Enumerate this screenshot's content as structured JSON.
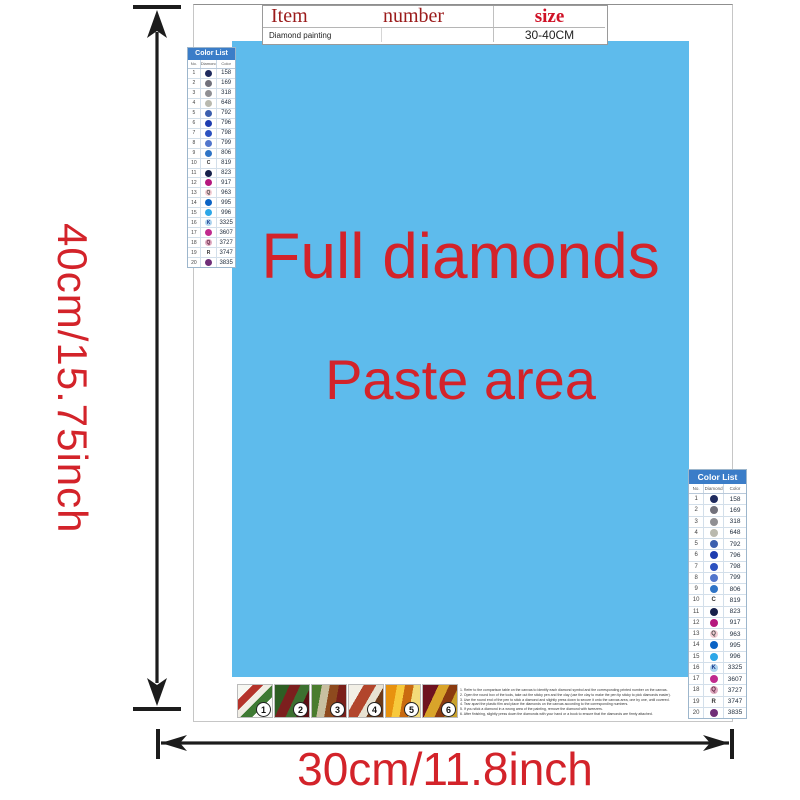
{
  "top_table": {
    "col_item": "Item",
    "col_number": "number",
    "col_size": "size",
    "row_item": "Diamond painting",
    "row_number": "",
    "row_size": "30-40CM"
  },
  "paste_area": {
    "line1": "Full diamonds",
    "line2": "Paste area",
    "bg_color": "#5ebbec",
    "text_color": "#d3232a"
  },
  "dimensions": {
    "height_label": "40cm/15.75inch",
    "width_label": "30cm/11.8inch",
    "arrow_color": "#1c1c1c",
    "label_color": "#d3232a"
  },
  "color_list": {
    "title": "Color List",
    "header_bg": "#3b7dc8",
    "col_no": "No.",
    "col_diamond": "Diamond",
    "col_color": "Color",
    "rows": [
      {
        "no": "1",
        "sym": "",
        "bg": "#1e2a5e",
        "fg": "#ffffff",
        "code": "158"
      },
      {
        "no": "2",
        "sym": "",
        "bg": "#71717b",
        "fg": "#ffffff",
        "code": "169"
      },
      {
        "no": "3",
        "sym": "",
        "bg": "#8f8f93",
        "fg": "#ffffff",
        "code": "318"
      },
      {
        "no": "4",
        "sym": "",
        "bg": "#b9b9ae",
        "fg": "#ffffff",
        "code": "648"
      },
      {
        "no": "5",
        "sym": "",
        "bg": "#3c5fae",
        "fg": "#ffffff",
        "code": "792"
      },
      {
        "no": "6",
        "sym": "",
        "bg": "#1e3db0",
        "fg": "#ffffff",
        "code": "796"
      },
      {
        "no": "7",
        "sym": "",
        "bg": "#2c52c0",
        "fg": "#ffffff",
        "code": "798"
      },
      {
        "no": "8",
        "sym": "",
        "bg": "#5276cc",
        "fg": "#ffffff",
        "code": "799"
      },
      {
        "no": "9",
        "sym": "",
        "bg": "#2f74c6",
        "fg": "#ffffff",
        "code": "806"
      },
      {
        "no": "10",
        "sym": "C",
        "bg": "none",
        "fg": "#333333",
        "code": "819"
      },
      {
        "no": "11",
        "sym": "",
        "bg": "#16204a",
        "fg": "#ffffff",
        "code": "823"
      },
      {
        "no": "12",
        "sym": "",
        "bg": "#b5187e",
        "fg": "#ffffff",
        "code": "917"
      },
      {
        "no": "13",
        "sym": "Q",
        "bg": "#f3cdd4",
        "fg": "#444444",
        "code": "963"
      },
      {
        "no": "14",
        "sym": "",
        "bg": "#0b63c5",
        "fg": "#ffffff",
        "code": "995"
      },
      {
        "no": "15",
        "sym": "",
        "bg": "#2da7e8",
        "fg": "#ffffff",
        "code": "996"
      },
      {
        "no": "16",
        "sym": "K",
        "bg": "#aed4ef",
        "fg": "#1a3a8c",
        "code": "3325"
      },
      {
        "no": "17",
        "sym": "",
        "bg": "#c02a8e",
        "fg": "#ffffff",
        "code": "3607"
      },
      {
        "no": "18",
        "sym": "Q",
        "bg": "#dfa9c0",
        "fg": "#5c2340",
        "code": "3727"
      },
      {
        "no": "19",
        "sym": "R",
        "bg": "none",
        "fg": "#333333",
        "code": "3747"
      },
      {
        "no": "20",
        "sym": "",
        "bg": "#6f2e78",
        "fg": "#ffffff",
        "code": "3835"
      }
    ]
  },
  "steps": {
    "items": [
      {
        "num": "1",
        "name": "step-photo-1",
        "cls": "t1"
      },
      {
        "num": "2",
        "name": "step-photo-2",
        "cls": "t2"
      },
      {
        "num": "3",
        "name": "step-photo-3",
        "cls": "t3"
      },
      {
        "num": "4",
        "name": "step-photo-4",
        "cls": "t4"
      },
      {
        "num": "5",
        "name": "step-photo-5",
        "cls": "t5"
      },
      {
        "num": "6",
        "name": "step-photo-6",
        "cls": "t6"
      }
    ]
  },
  "instructions": {
    "lines": [
      "1. Refer to the comparison table on the canvas to identify each diamond symbol and the corresponding printed number on the canvas.",
      "2. Open the round box of the tools, take out the sticky pen and the clay (use the clay to make the pen tip sticky to pick diamonds easier).",
      "3. Use the round end of the pen to stick a diamond and slightly press down to secure it onto the canvas area, one by one, until covered.",
      "4. Tear apart the plastic film and place the diamonds on the canvas according to the corresponding numbers.",
      "5. If you stick a diamond in a wrong area of the painting, remove the diamond with tweezers.",
      "6. After finishing, slightly press down the diamonds with your hand or a book to ensure that the diamonds are firmly attached."
    ]
  }
}
